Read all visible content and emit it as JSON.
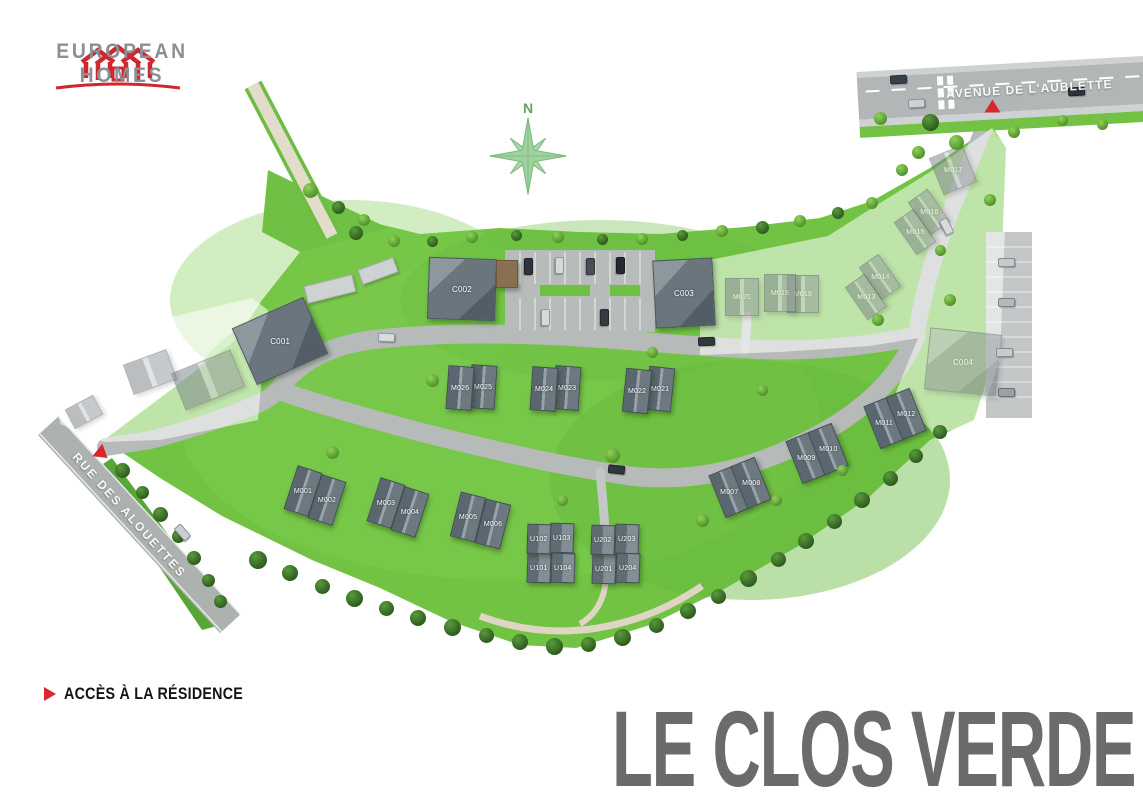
{
  "brand": {
    "line1": "EUROPEAN",
    "line2": "HOMES"
  },
  "title": "LE CLOS VERDE",
  "legend": {
    "access_label": "ACCÈS À LA RÉSIDENCE"
  },
  "compass": {
    "north_label": "N"
  },
  "streets": {
    "avenue": "AVENUE DE L'AUBLETTE",
    "rue": "RUE DES ALOUETTES"
  },
  "colors": {
    "accent_red": "#D7282F",
    "title_gray": "#6B6B6E",
    "logo_gray": "#8A9096",
    "terrain_green": "#72C344",
    "road_gray": "#B6BAB9"
  },
  "map": {
    "lots": [
      {
        "label": "M001",
        "x": 303,
        "y": 491,
        "w": 26,
        "h": 46,
        "rot": 18,
        "kind": "house",
        "phase": "1"
      },
      {
        "label": "M002",
        "x": 327,
        "y": 500,
        "w": 26,
        "h": 46,
        "rot": 18,
        "kind": "house",
        "phase": "1"
      },
      {
        "label": "M003",
        "x": 386,
        "y": 503,
        "w": 26,
        "h": 46,
        "rot": 18,
        "kind": "house",
        "phase": "1"
      },
      {
        "label": "M004",
        "x": 410,
        "y": 512,
        "w": 26,
        "h": 46,
        "rot": 18,
        "kind": "house",
        "phase": "1"
      },
      {
        "label": "M005",
        "x": 468,
        "y": 517,
        "w": 26,
        "h": 46,
        "rot": 14,
        "kind": "house",
        "phase": "1"
      },
      {
        "label": "M006",
        "x": 493,
        "y": 524,
        "w": 26,
        "h": 46,
        "rot": 14,
        "kind": "house",
        "phase": "1"
      },
      {
        "label": "M007",
        "x": 729,
        "y": 492,
        "w": 26,
        "h": 46,
        "rot": -22,
        "kind": "house",
        "phase": "1"
      },
      {
        "label": "M008",
        "x": 751,
        "y": 483,
        "w": 26,
        "h": 46,
        "rot": -22,
        "kind": "house",
        "phase": "1"
      },
      {
        "label": "M009",
        "x": 806,
        "y": 458,
        "w": 26,
        "h": 46,
        "rot": -22,
        "kind": "house",
        "phase": "1"
      },
      {
        "label": "M010",
        "x": 828,
        "y": 449,
        "w": 26,
        "h": 46,
        "rot": -22,
        "kind": "house",
        "phase": "1"
      },
      {
        "label": "M011",
        "x": 884,
        "y": 423,
        "w": 26,
        "h": 46,
        "rot": -22,
        "kind": "house",
        "phase": "1"
      },
      {
        "label": "M012",
        "x": 906,
        "y": 414,
        "w": 26,
        "h": 46,
        "rot": -22,
        "kind": "house",
        "phase": "1"
      },
      {
        "label": "M021",
        "x": 660,
        "y": 389,
        "w": 26,
        "h": 44,
        "rot": 6,
        "kind": "house",
        "phase": "1"
      },
      {
        "label": "M022",
        "x": 637,
        "y": 391,
        "w": 26,
        "h": 44,
        "rot": 6,
        "kind": "house",
        "phase": "1"
      },
      {
        "label": "M023",
        "x": 567,
        "y": 388,
        "w": 26,
        "h": 44,
        "rot": 4,
        "kind": "house",
        "phase": "1"
      },
      {
        "label": "M024",
        "x": 544,
        "y": 389,
        "w": 26,
        "h": 44,
        "rot": 4,
        "kind": "house",
        "phase": "1"
      },
      {
        "label": "M025",
        "x": 483,
        "y": 387,
        "w": 26,
        "h": 44,
        "rot": 4,
        "kind": "house",
        "phase": "1"
      },
      {
        "label": "M026",
        "x": 460,
        "y": 388,
        "w": 26,
        "h": 44,
        "rot": 4,
        "kind": "house",
        "phase": "1"
      },
      {
        "label": "U101",
        "x": 539,
        "y": 568,
        "w": 24,
        "h": 30,
        "rot": 2,
        "kind": "u",
        "phase": "1"
      },
      {
        "label": "U102",
        "x": 539,
        "y": 539,
        "w": 24,
        "h": 30,
        "rot": 2,
        "kind": "u",
        "phase": "1"
      },
      {
        "label": "U103",
        "x": 562,
        "y": 538,
        "w": 24,
        "h": 30,
        "rot": 2,
        "kind": "u",
        "phase": "1"
      },
      {
        "label": "U104",
        "x": 563,
        "y": 568,
        "w": 24,
        "h": 30,
        "rot": 2,
        "kind": "u",
        "phase": "1"
      },
      {
        "label": "U201",
        "x": 604,
        "y": 569,
        "w": 24,
        "h": 30,
        "rot": 2,
        "kind": "u",
        "phase": "1"
      },
      {
        "label": "U202",
        "x": 603,
        "y": 540,
        "w": 24,
        "h": 30,
        "rot": 2,
        "kind": "u",
        "phase": "1"
      },
      {
        "label": "U203",
        "x": 627,
        "y": 539,
        "w": 24,
        "h": 30,
        "rot": 2,
        "kind": "u",
        "phase": "1"
      },
      {
        "label": "U204",
        "x": 628,
        "y": 568,
        "w": 24,
        "h": 30,
        "rot": 2,
        "kind": "u",
        "phase": "1"
      },
      {
        "label": "C001",
        "x": 280,
        "y": 341,
        "w": 78,
        "h": 62,
        "rot": -24,
        "kind": "big",
        "phase": "1"
      },
      {
        "label": "C002",
        "x": 462,
        "y": 289,
        "w": 68,
        "h": 62,
        "rot": 2,
        "kind": "big",
        "phase": "1"
      },
      {
        "label": "C003",
        "x": 684,
        "y": 293,
        "w": 60,
        "h": 68,
        "rot": -3,
        "kind": "big",
        "phase": "1"
      },
      {
        "label": "C004",
        "x": 963,
        "y": 362,
        "w": 72,
        "h": 62,
        "rot": 6,
        "kind": "big",
        "phase": "2"
      },
      {
        "label": "M013",
        "x": 866,
        "y": 297,
        "w": 24,
        "h": 40,
        "rot": -35,
        "kind": "house",
        "phase": "2"
      },
      {
        "label": "M014",
        "x": 880,
        "y": 277,
        "w": 24,
        "h": 40,
        "rot": -35,
        "kind": "house",
        "phase": "2"
      },
      {
        "label": "M015",
        "x": 915,
        "y": 232,
        "w": 24,
        "h": 40,
        "rot": -35,
        "kind": "house",
        "phase": "2"
      },
      {
        "label": "M016",
        "x": 929,
        "y": 212,
        "w": 24,
        "h": 40,
        "rot": -35,
        "kind": "house",
        "phase": "2"
      },
      {
        "label": "M017",
        "x": 953,
        "y": 170,
        "w": 36,
        "h": 40,
        "rot": -22,
        "kind": "house",
        "phase": "2"
      },
      {
        "label": "M018",
        "x": 803,
        "y": 294,
        "w": 32,
        "h": 38,
        "rot": 0,
        "kind": "house",
        "phase": "2"
      },
      {
        "label": "M019",
        "x": 780,
        "y": 293,
        "w": 32,
        "h": 38,
        "rot": 0,
        "kind": "house",
        "phase": "2"
      },
      {
        "label": "M020",
        "x": 742,
        "y": 297,
        "w": 34,
        "h": 38,
        "rot": 0,
        "kind": "house",
        "phase": "2"
      },
      {
        "label": "",
        "x": 208,
        "y": 380,
        "w": 64,
        "h": 40,
        "rot": -22,
        "kind": "house",
        "phase": "2"
      },
      {
        "label": "",
        "x": 150,
        "y": 372,
        "w": 46,
        "h": 32,
        "rot": -20,
        "kind": "house",
        "phase": "2"
      },
      {
        "label": "",
        "x": 84,
        "y": 412,
        "w": 32,
        "h": 22,
        "rot": -28,
        "kind": "house",
        "phase": "2"
      },
      {
        "label": "",
        "x": 507,
        "y": 274,
        "w": 22,
        "h": 28,
        "rot": 0,
        "kind": "shed",
        "phase": "1"
      },
      {
        "label": "",
        "x": 330,
        "y": 289,
        "w": 50,
        "h": 18,
        "rot": -14,
        "kind": "garage",
        "phase": "1"
      },
      {
        "label": "",
        "x": 378,
        "y": 271,
        "w": 38,
        "h": 16,
        "rot": -20,
        "kind": "garage",
        "phase": "1"
      }
    ]
  }
}
